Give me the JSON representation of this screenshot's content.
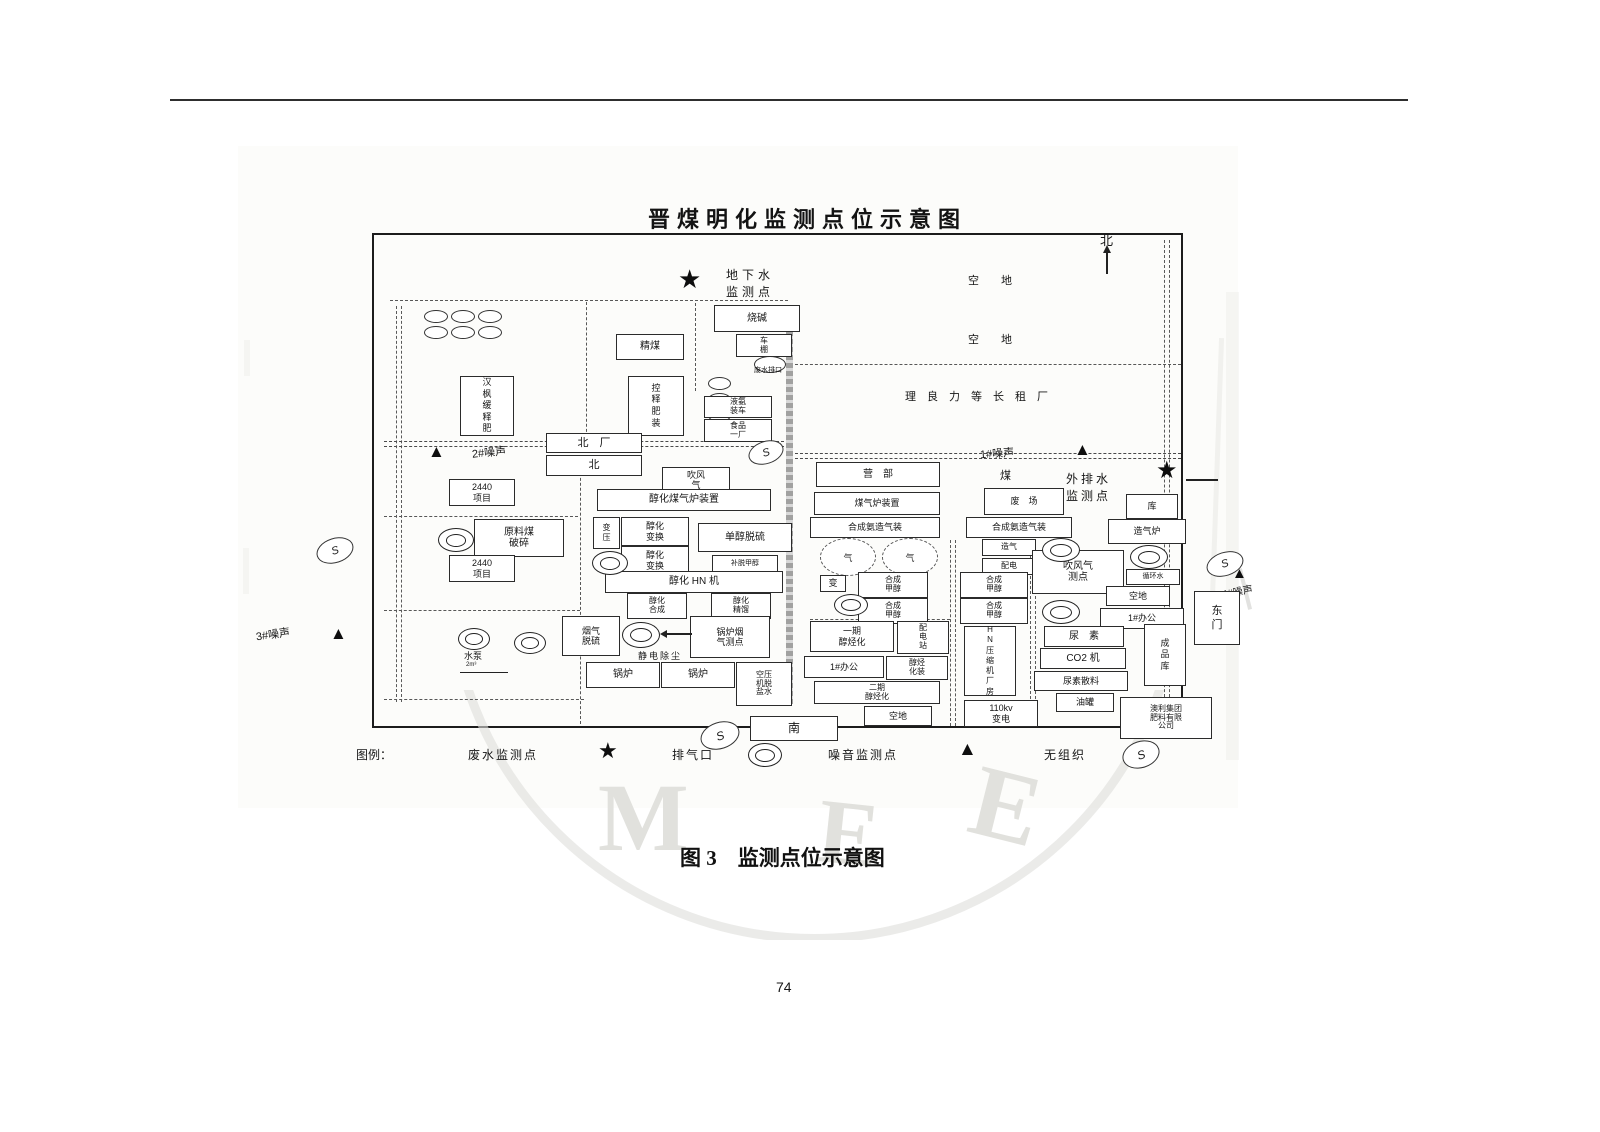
{
  "page": {
    "number": "74",
    "caption": "图 3　监测点位示意图",
    "watermark": {
      "letters": [
        "M",
        "E",
        "E"
      ]
    }
  },
  "icons": {
    "star": "★",
    "triangle": "▲",
    "fugitive": "S",
    "gas_holder": "气"
  },
  "diagram": {
    "title": "晋煤明化监测点位示意图",
    "compass_north": "北",
    "noise_points": {
      "n1": "1#噪声",
      "n2": "2#噪声",
      "n3": "3#噪声",
      "n4": "4#噪声"
    },
    "monitor_labels": {
      "groundwater": "地下水\n监测点",
      "outfall": "外排水\n监测点"
    },
    "area_labels": {
      "open1": "空　　地",
      "open2": "空　　地",
      "tenant": "理良力等长租厂",
      "coal": "煤",
      "outfall_small": "废水排口",
      "pump": "水泵",
      "pump_sub": "2m³",
      "esp": "静电除尘"
    },
    "gates": {
      "north_plant": "北　厂",
      "north": "北",
      "south": "南",
      "east": "东门"
    },
    "boxes": {
      "caustic": "烧碱",
      "shed": "车\n棚",
      "coal_store": "精煤",
      "hanfeng": "汉枫缓释肥",
      "crf_pack": "控释肥装",
      "ammonia_load": "液氨\n装车",
      "food_plant": "食品\n一厂",
      "blower": "吹风\n气",
      "gasifier_unit": "醇化煤气炉装置",
      "transformer": "变压",
      "shift1": "醇化\n变换",
      "shift2": "醇化\n变换",
      "desulfur": "单醇脱硫",
      "methanol_strip": "补脱甲醇",
      "hn_unit": "醇化 HN 机",
      "synthesis_l": "醇化\n合成",
      "distill": "醇化\n精馏",
      "p2440a": "2440\n项目",
      "raw_coal": "原料煤\n破碎",
      "p2440b": "2440\n项目",
      "fgd": "烟气\n脱硫",
      "flue_point": "锅炉烟\n气测点",
      "boiler1": "锅炉",
      "boiler2": "锅炉",
      "air_comp": "空压\n机脱\n盐水",
      "camp": "营　部",
      "gas_furnace": "煤气炉装置",
      "waste_yard": "废　场",
      "warehouse": "库",
      "syngas1": "合成氨造气装",
      "syngas2": "合成氨造气装",
      "gas_making": "造气",
      "power_dist": "配电",
      "blowgas_point": "吹风气\n测点",
      "gas_furnace2": "造气炉",
      "circ_water": "循环水",
      "open_r": "空地",
      "office_r": "1#办公",
      "trans_small": "变",
      "syn1": "合成\n甲醇",
      "syn2": "合成\n甲醇",
      "syn3": "合成\n甲醇",
      "syn4": "合成\n甲醇",
      "phase1": "一期\n醇烃化",
      "substation": "配\n电\n站",
      "office_l": "1#办公",
      "hydrocarbon": "醇烃\n化装",
      "phase2": "二期\n醇烃化",
      "open_b": "空地",
      "kv110": "110kv\n变电",
      "hn_comp": "HN压缩机厂房",
      "urea": "尿　素",
      "co2": "CO2 机",
      "urea_bulk": "尿素散料",
      "oil_tank": "油罐",
      "product_store": "成品库",
      "aoli": "澳利集团\n肥料有限\n公司"
    },
    "legend": {
      "title": "图例：",
      "wastewater": "废水监测点",
      "vent": "排气口",
      "noise": "噪音监测点",
      "fugitive": "无组织"
    }
  }
}
